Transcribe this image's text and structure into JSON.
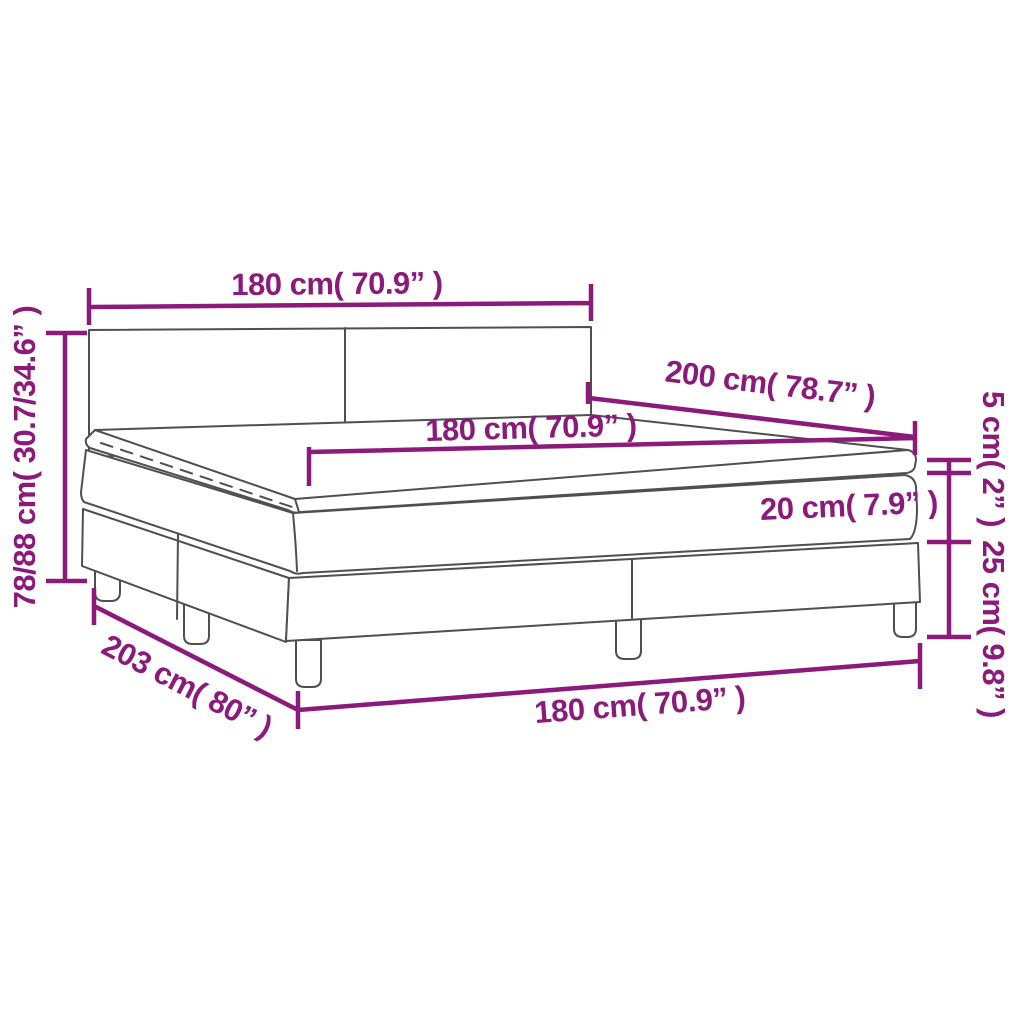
{
  "diagram": {
    "kind": "product-dimension-diagram",
    "subject": "box spring bed with mattress and topper",
    "accent_color": "#8B1A7B",
    "line_color": "#4F4F4F",
    "background_color": "#FFFFFF",
    "dimensions": {
      "headboard_width": "180 cm( 70.9” )",
      "overall_height": "78/88 cm( 30.7/34.6” )",
      "length": "200 cm( 78.7” )",
      "mattress_width": "180 cm( 70.9” )",
      "topper_height": "5 cm( 2” )",
      "mattress_height": "20 cm( 7.9” )",
      "base_height": "25 cm( 9.8” )",
      "base_length": "203 cm( 80” )",
      "base_width": "180 cm( 70.9” )"
    }
  }
}
